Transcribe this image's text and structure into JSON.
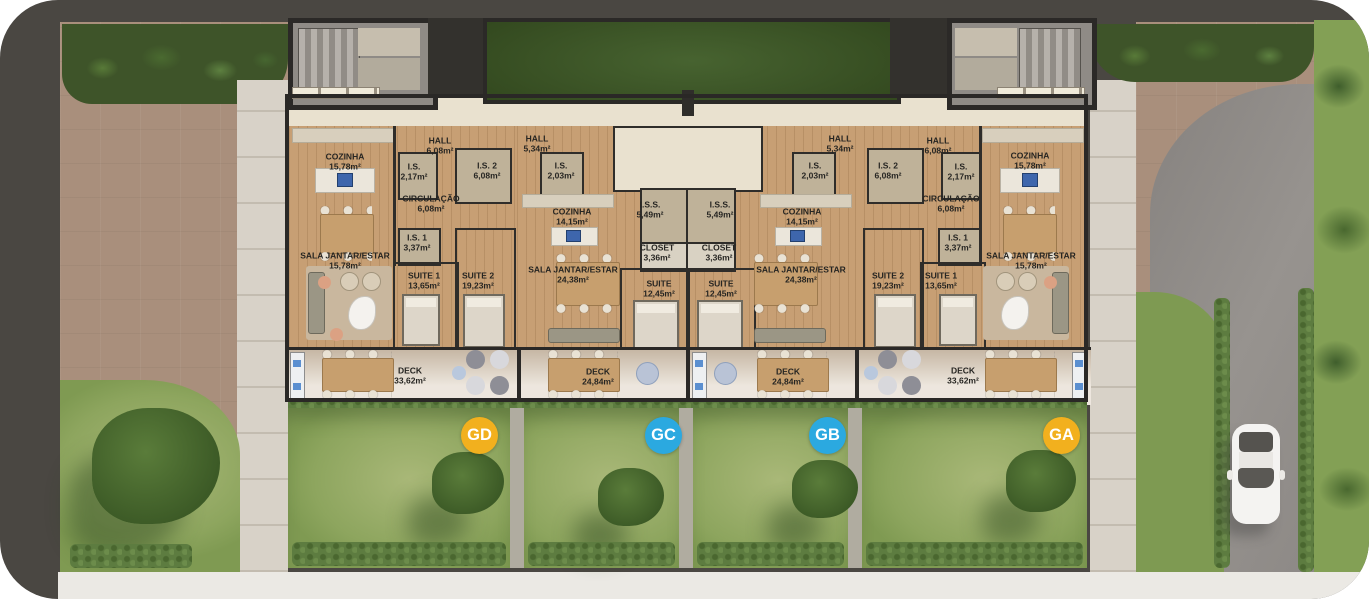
{
  "badges": [
    {
      "id": "gd",
      "label": "GD",
      "color": "#F2B01E"
    },
    {
      "id": "gc",
      "label": "GC",
      "color": "#2BA9E0"
    },
    {
      "id": "gb",
      "label": "GB",
      "color": "#2BA9E0"
    },
    {
      "id": "ga",
      "label": "GA",
      "color": "#F2B01E"
    }
  ],
  "units": {
    "GD": {
      "rooms": {
        "cozinha": {
          "name": "COZINHA",
          "area": "15,78m²"
        },
        "hall": {
          "name": "HALL",
          "area": "6,08m²"
        },
        "is": {
          "name": "I.S.",
          "area": "2,17m²"
        },
        "is2": {
          "name": "I.S. 2",
          "area": "6,08m²"
        },
        "circulacao": {
          "name": "CIRCULAÇÃO",
          "area": "6,08m²"
        },
        "is1": {
          "name": "I.S. 1",
          "area": "3,37m²"
        },
        "sala": {
          "name": "SALA JANTAR/ESTAR",
          "area": "15,78m²"
        },
        "suite1": {
          "name": "SUITE 1",
          "area": "13,65m²"
        },
        "suite2": {
          "name": "SUITE 2",
          "area": "19,23m²"
        },
        "deck": {
          "name": "DECK",
          "area": "33,62m²"
        }
      }
    },
    "GC": {
      "rooms": {
        "hall": {
          "name": "HALL",
          "area": "5,34m²"
        },
        "is": {
          "name": "I.S.",
          "area": "2,03m²"
        },
        "cozinha": {
          "name": "COZINHA",
          "area": "14,15m²"
        },
        "iss": {
          "name": "I.S.S.",
          "area": "5,49m²"
        },
        "closet": {
          "name": "CLOSET",
          "area": "3,36m²"
        },
        "suite": {
          "name": "SUITE",
          "area": "12,45m²"
        },
        "sala": {
          "name": "SALA JANTAR/ESTAR",
          "area": "24,38m²"
        },
        "deck": {
          "name": "DECK",
          "area": "24,84m²"
        }
      }
    },
    "GB": {
      "rooms": {
        "hall": {
          "name": "HALL",
          "area": "5,34m²"
        },
        "is": {
          "name": "I.S.",
          "area": "2,03m²"
        },
        "cozinha": {
          "name": "COZINHA",
          "area": "14,15m²"
        },
        "iss": {
          "name": "I.S.S.",
          "area": "5,49m²"
        },
        "closet": {
          "name": "CLOSET",
          "area": "3,36m²"
        },
        "suite": {
          "name": "SUITE",
          "area": "12,45m²"
        },
        "sala": {
          "name": "SALA JANTAR/ESTAR",
          "area": "24,38m²"
        },
        "deck": {
          "name": "DECK",
          "area": "24,84m²"
        }
      }
    },
    "GA": {
      "rooms": {
        "cozinha": {
          "name": "COZINHA",
          "area": "15,78m²"
        },
        "hall": {
          "name": "HALL",
          "area": "6,08m²"
        },
        "is": {
          "name": "I.S.",
          "area": "2,17m²"
        },
        "is2": {
          "name": "I.S. 2",
          "area": "6,08m²"
        },
        "circulacao": {
          "name": "CIRCULAÇÃO",
          "area": "6,08m²"
        },
        "is1": {
          "name": "I.S. 1",
          "area": "3,37m²"
        },
        "sala": {
          "name": "SALA JANTAR/ESTAR",
          "area": "15,78m²"
        },
        "suite1": {
          "name": "SUITE 1",
          "area": "13,65m²"
        },
        "suite2": {
          "name": "SUITE 2",
          "area": "19,23m²"
        },
        "deck": {
          "name": "DECK",
          "area": "33,62m²"
        }
      }
    }
  }
}
